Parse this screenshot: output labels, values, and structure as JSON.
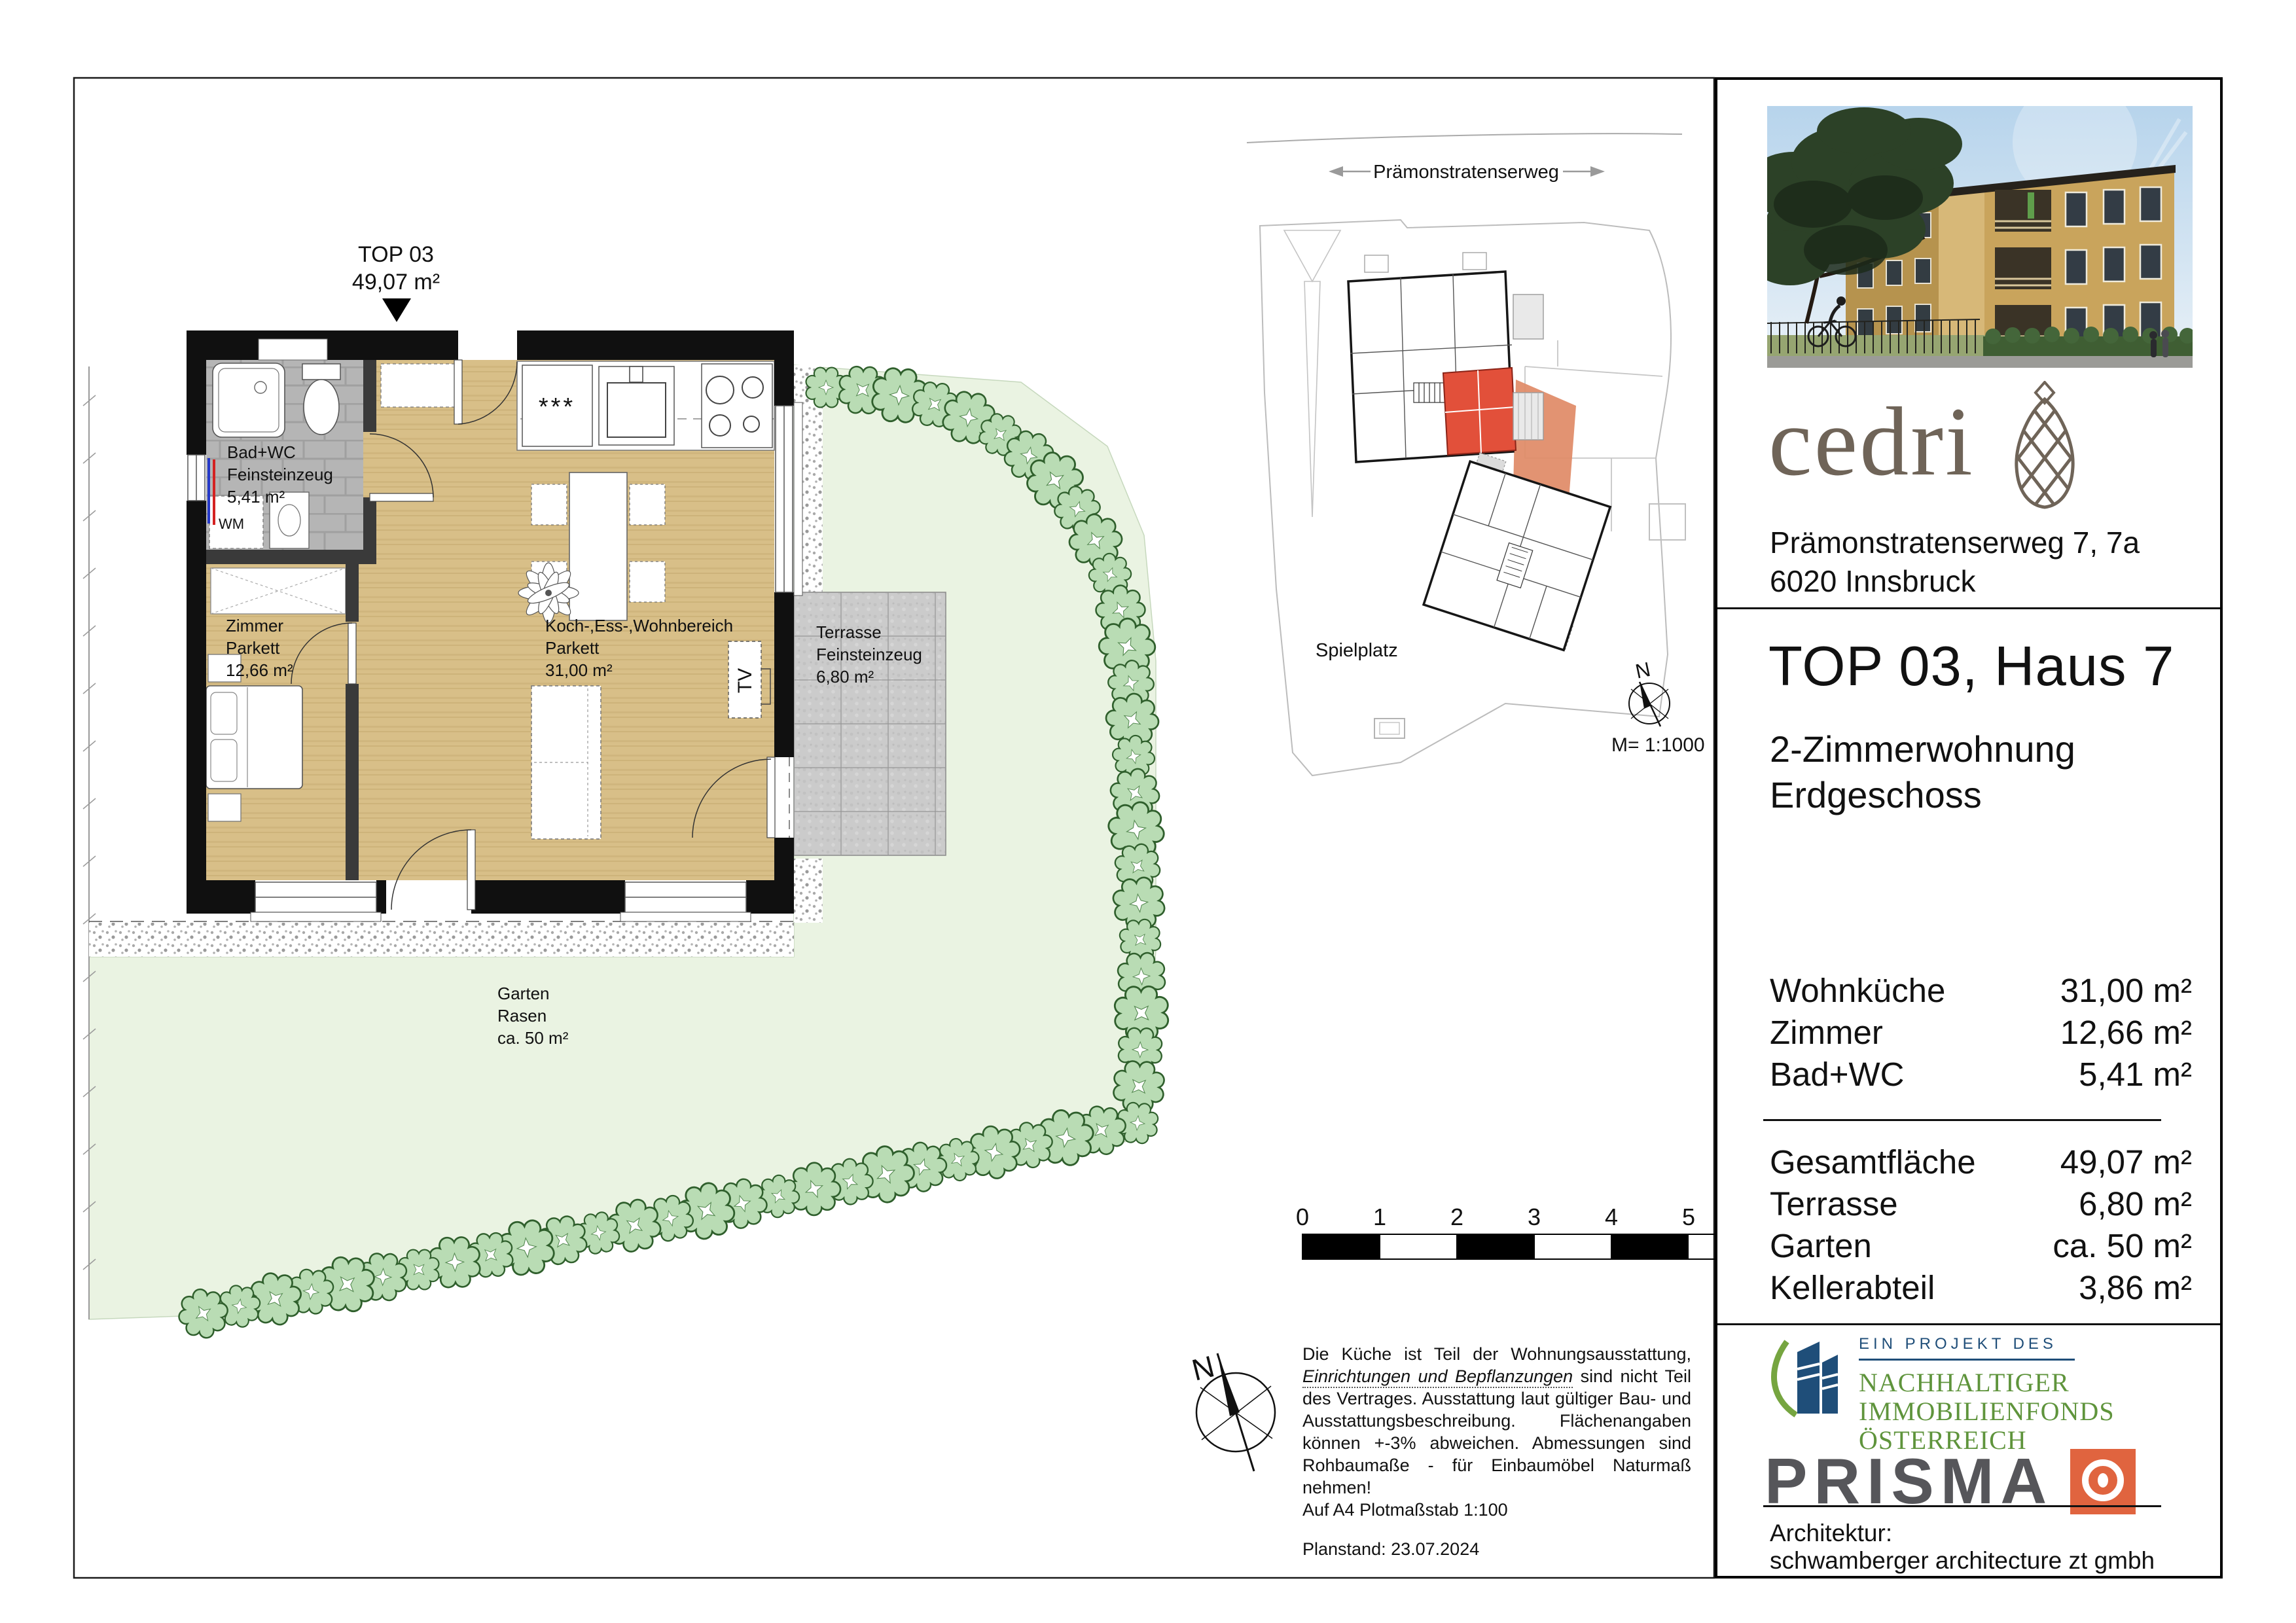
{
  "plan": {
    "unit_label": "TOP 03",
    "unit_area": "49,07 m²",
    "rooms": {
      "bad": {
        "name": "Bad+WC",
        "floor": "Feinsteinzeug",
        "area": "5,41 m²"
      },
      "zimmer": {
        "name": "Zimmer",
        "floor": "Parkett",
        "area": "12,66 m²"
      },
      "wohn": {
        "name": "Koch-,Ess-,Wohnbereich",
        "floor": "Parkett",
        "area": "31,00 m²"
      },
      "terrasse": {
        "name": "Terrasse",
        "floor": "Feinsteinzeug",
        "area": "6,80 m²"
      },
      "garten": {
        "name": "Garten",
        "floor": "Rasen",
        "area": "ca. 50 m²"
      }
    },
    "labels": {
      "wm": "WM",
      "tv": "TV",
      "fridge": "***"
    }
  },
  "siteplan": {
    "street": "Prämonstratenserweg",
    "playground": "Spielplatz",
    "north": "N",
    "scale": "M= 1:1000"
  },
  "footer": {
    "scalebar_ticks": [
      "0",
      "1",
      "2",
      "3",
      "4",
      "5"
    ],
    "north": "N",
    "disclaimer_line1": "Die Küche ist Teil der Wohnungsausstattung,",
    "disclaimer_italic": "Einrichtungen und Bepflanzungen",
    "disclaimer_rest": " sind nicht Teil des Vertrages. Ausstattung laut gültiger Bau- und Ausstattungsbeschreibung. Flächenangaben können +-3% abweichen. Abmessungen sind Rohbaumaße - für Einbaumöbel Naturmaß nehmen!",
    "disclaimer_last": "Auf A4 Plotmaßstab 1:100",
    "plan_date": "Planstand: 23.07.2024"
  },
  "panel": {
    "logo": "cedri",
    "address_line1": "Prämonstratenserweg 7, 7a",
    "address_line2": "6020 Innsbruck",
    "title": "TOP 03, Haus 7",
    "subtitle_line1": "2-Zimmerwohnung",
    "subtitle_line2": "Erdgeschoss",
    "rooms": [
      {
        "label": "Wohnküche",
        "value": "31,00 m²"
      },
      {
        "label": "Zimmer",
        "value": "12,66 m²"
      },
      {
        "label": "Bad+WC",
        "value": "5,41 m²"
      }
    ],
    "totals": [
      {
        "label": "Gesamtfläche",
        "value": "49,07 m²"
      },
      {
        "label": "Terrasse",
        "value": "6,80 m²"
      },
      {
        "label": "Garten",
        "value": "ca. 50 m²"
      },
      {
        "label": "Kellerabteil",
        "value": "3,86 m²"
      }
    ],
    "project_kicker": "EIN PROJEKT DES",
    "fund_line1": "NACHHALTIGER",
    "fund_line2": "IMMOBILIENFONDS",
    "fund_line3": "ÖSTERREICH",
    "prisma": "PRISMA",
    "architect_label": "Architektur:",
    "architect_name": "schwamberger architecture zt gmbh"
  },
  "colors": {
    "unit_red": "#e2503a",
    "unit_garden_orange": "#e08a66",
    "prisma_orange": "#e0643f",
    "fund_green": "#5f943c",
    "fund_blue": "#1f4e79",
    "cedri_brown": "#6f6458",
    "wood_floor": "#d8bf88",
    "garden_green": "#eaf3e2"
  }
}
